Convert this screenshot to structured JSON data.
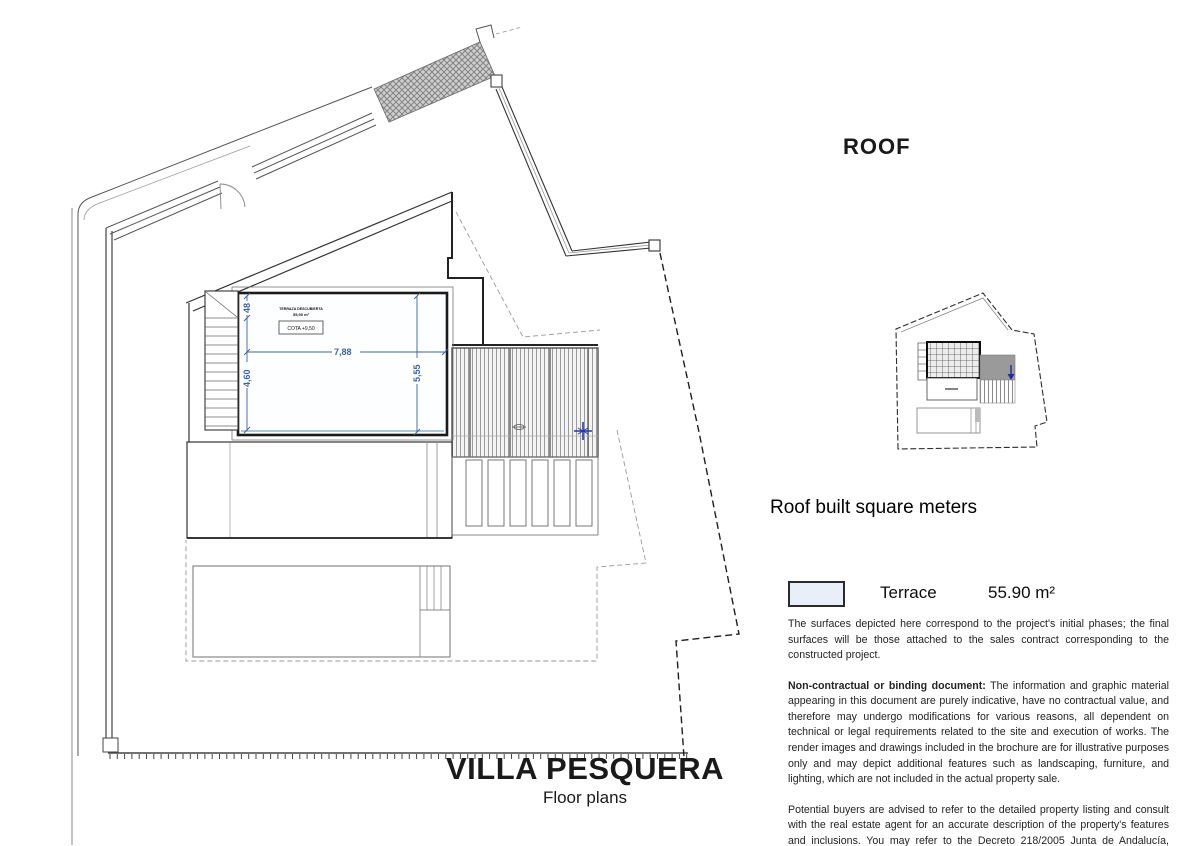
{
  "document": {
    "title_main": "VILLA PESQUERA",
    "title_sub": "Floor plans"
  },
  "roof_plan": {
    "title": "ROOF",
    "dims": {
      "width": "7,88",
      "height_right": "5,55",
      "height_left_lower": "4,60",
      "height_left_upper": "48"
    },
    "terrace_note": {
      "line1": "TERRAZA DESCUBIERTA",
      "line2": "55,90 m²",
      "cota": "COTA +9,50"
    }
  },
  "summary": {
    "heading": "Roof built square meters",
    "legend": [
      {
        "label": "Terrace",
        "value": "55.90 m²",
        "swatch_color": "#e9eff8"
      }
    ]
  },
  "disclaimer": {
    "p1": "The surfaces depicted here correspond to the project's initial phases; the final surfaces will be those attached to the sales contract corresponding to the constructed project.",
    "p2_bold": "Non-contractual or binding document:",
    "p2_rest": " The information and graphic material appearing in this document are purely indicative, have no contractual value, and therefore may undergo modifications for various reasons, all dependent on technical or legal requirements related to the site and execution of works. The render images and drawings included in the brochure are for illustrative purposes only and may depict additional features such as landscaping, furniture, and lighting, which are not included in the actual property sale.",
    "p3": "Potential buyers are advised to refer to the detailed property listing and consult with the real estate agent for an accurate description of the property's features and inclusions. You may refer to the Decreto 218/2005 Junta de Andalucía, available at our offices."
  },
  "colors": {
    "dimension_blue": "#3c62a8",
    "marker_blue": "#2238a8",
    "terrace_swatch": "#e9eff8",
    "roof_gray_fill": "#9a9a9a"
  }
}
